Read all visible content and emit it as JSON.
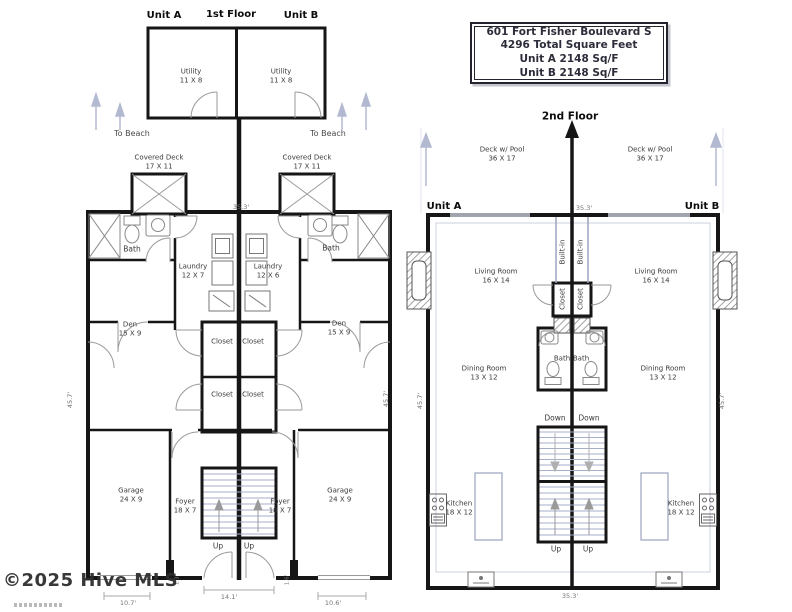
{
  "info_box": {
    "lines": [
      "601 Fort Fisher Boulevard S",
      "4296 Total Square Feet",
      "Unit A 2148 Sq/F",
      "Unit B 2148 Sq/F"
    ]
  },
  "floor1": {
    "title": "1st Floor",
    "unit_a": "Unit A",
    "unit_b": "Unit B",
    "utility": "Utility\n11 X 8",
    "to_beach": "To Beach",
    "covered_deck": "Covered Deck\n17 X 11",
    "bath": "Bath",
    "laundry_a": "Laundry\n12 X 7",
    "laundry_b": "Laundry\n12 X 6",
    "den": "Den\n15 X 9",
    "closet": "Closet",
    "garage": "Garage\n24 X 9",
    "foyer": "Foyer\n18 X 7",
    "up": "Up",
    "dims": {
      "width_top": "35.3'",
      "depth_left": "45.7'",
      "depth_right": "45.7'",
      "garage_door_left": "10.7'",
      "entry": "14.1'",
      "garage_door_right": "10.6'",
      "stub_left": "1.3'",
      "stub_right": "1.6'"
    }
  },
  "floor2": {
    "title": "2nd Floor",
    "unit_a": "Unit A",
    "unit_b": "Unit B",
    "deck": "Deck w/ Pool\n36 X 17",
    "living": "Living Room\n16 X 14",
    "built_in": "Built-in",
    "closet": "Closet",
    "bath": "Bath",
    "dining": "Dining Room\n13 X 12",
    "down": "Down",
    "kitchen": "Kitchen\n18 X 12",
    "up": "Up",
    "dims": {
      "width_top": "35.3'",
      "width_bottom": "35.3'",
      "depth_left": "45.7'",
      "depth_right": "45.7'"
    }
  },
  "watermark": {
    "text": "©2025 Hive MLS"
  },
  "colors": {
    "walls": "#161616",
    "fixtures": "#8d8d8d",
    "light_fixture": "#9aa3bf",
    "beach_arrow": "#b3b9d1",
    "background": "#ffffff"
  }
}
